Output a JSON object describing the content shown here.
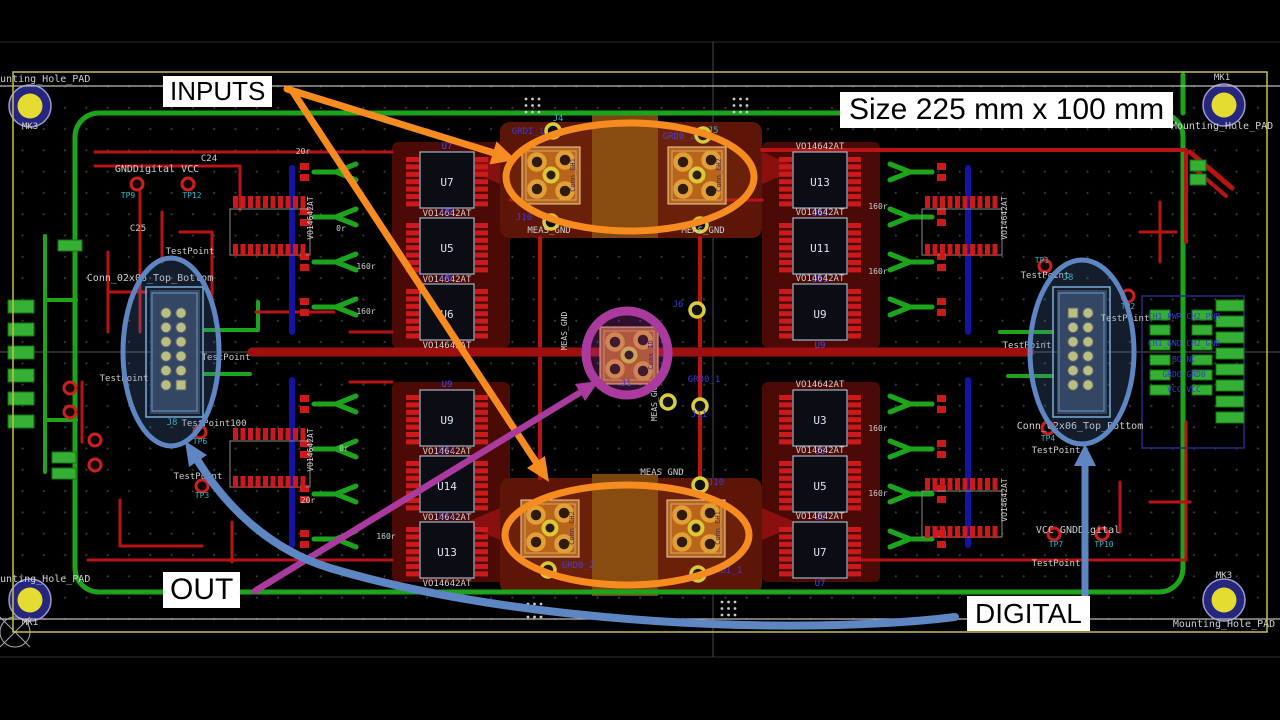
{
  "annotations": {
    "inputs": "INPUTS",
    "out": "OUT",
    "digital": "DIGITAL",
    "size": "Size 225 mm x 100 mm"
  },
  "colors": {
    "annotation_orange": "#f68b1f",
    "annotation_purple": "#aa3a9e",
    "annotation_blue": "#5d86c2",
    "trace_red": "#b81414",
    "trace_green": "#1ca51c",
    "copper_zone": "#4c0a06",
    "zone_orange": "#5c1507",
    "zone_brown": "#7c450f",
    "coax_body": "#b2611b",
    "board_outline": "#c8bd4a",
    "pad_yellow": "#d8ce3c",
    "pad_red": "#cc1a1a",
    "ring_orange": "#e0a238",
    "mount_yellow": "#e5dc31",
    "mount_ring": "#26267e",
    "silk_white": "#cfcfcf",
    "net_blue": "#3a3ad8",
    "tp_teal": "#27b9c9",
    "ic_ref": "#d9e4f2",
    "blue_ref": "#4848ee",
    "header_pad": "#d6cf6e",
    "header_stroke": "#85b8dc"
  },
  "board": {
    "ic_columns": [
      {
        "cx": 447,
        "ref_above": true,
        "value": "VO14642AT",
        "parts": [
          {
            "ref": "U7",
            "y": 152
          },
          {
            "ref": "U5",
            "y": 218
          },
          {
            "ref": "U6",
            "y": 284
          },
          {
            "ref": "U9",
            "y": 390
          },
          {
            "ref": "U14",
            "y": 456
          },
          {
            "ref": "U13",
            "y": 522
          }
        ]
      },
      {
        "cx": 820,
        "ref_above": false,
        "value": "VO14642AT",
        "parts": [
          {
            "ref": "U13",
            "y": 152
          },
          {
            "ref": "U11",
            "y": 218
          },
          {
            "ref": "U9",
            "y": 284
          },
          {
            "ref": "U3",
            "y": 390
          },
          {
            "ref": "U5",
            "y": 456
          },
          {
            "ref": "U7",
            "y": 522
          }
        ]
      }
    ],
    "coax_connectors": [
      {
        "x": 522,
        "y": 147,
        "label": "Conn_CH1"
      },
      {
        "x": 668,
        "y": 147,
        "label": "Conn_CH2"
      },
      {
        "x": 600,
        "y": 327,
        "label": "Coax_ID"
      },
      {
        "x": 521,
        "y": 500,
        "label": "Conn_CH2"
      },
      {
        "x": 667,
        "y": 500,
        "label": "Conn_CH1"
      }
    ],
    "silk_texts": [
      {
        "t": "Mounting_Hole_PAD",
        "x": -12,
        "y": 82,
        "c": "silk_white",
        "s": 10,
        "a": "start"
      },
      {
        "t": "MK3",
        "x": 30,
        "y": 129,
        "c": "silk_white",
        "s": 9
      },
      {
        "t": "MK1",
        "x": 1222,
        "y": 80,
        "c": "silk_white",
        "s": 9
      },
      {
        "t": "Mounting_Hole_PAD",
        "x": 1222,
        "y": 129,
        "c": "silk_white",
        "s": 10
      },
      {
        "t": "Mounting_Hole_PAD",
        "x": -12,
        "y": 582,
        "c": "silk_white",
        "s": 10,
        "a": "start"
      },
      {
        "t": "MK1",
        "x": 30,
        "y": 625,
        "c": "silk_white",
        "s": 9
      },
      {
        "t": "MK3",
        "x": 1224,
        "y": 578,
        "c": "silk_white",
        "s": 9
      },
      {
        "t": "Mounting_Hole_PAD",
        "x": 1224,
        "y": 627,
        "c": "silk_white",
        "s": 10
      },
      {
        "t": "GNDDigital VCC",
        "x": 157,
        "y": 172,
        "c": "silk_white",
        "s": 10
      },
      {
        "t": "TP9",
        "x": 128,
        "y": 198,
        "c": "tp_teal",
        "s": 8
      },
      {
        "t": "TP12",
        "x": 192,
        "y": 198,
        "c": "tp_teal",
        "s": 8
      },
      {
        "t": "C24",
        "x": 209,
        "y": 161,
        "c": "silk_white",
        "s": 9
      },
      {
        "t": "C25",
        "x": 138,
        "y": 231,
        "c": "silk_white",
        "s": 9
      },
      {
        "t": "Conn_02x06_Top_Bottom",
        "x": 150,
        "y": 281,
        "c": "silk_white",
        "s": 10
      },
      {
        "t": "TestPoint",
        "x": 190,
        "y": 254,
        "c": "silk_white",
        "s": 9
      },
      {
        "t": "TestPoint",
        "x": 226,
        "y": 360,
        "c": "silk_white",
        "s": 9
      },
      {
        "t": "TestPoint",
        "x": 124,
        "y": 381,
        "c": "silk_white",
        "s": 9
      },
      {
        "t": "J8",
        "x": 172,
        "y": 425,
        "c": "tp_teal",
        "s": 9
      },
      {
        "t": "TestPoint100",
        "x": 214,
        "y": 426,
        "c": "silk_white",
        "s": 9
      },
      {
        "t": "TP6",
        "x": 200,
        "y": 444,
        "c": "tp_teal",
        "s": 8
      },
      {
        "t": "TestPoint",
        "x": 198,
        "y": 479,
        "c": "silk_white",
        "s": 9
      },
      {
        "t": "TP3",
        "x": 202,
        "y": 498,
        "c": "tp_teal",
        "s": 8
      },
      {
        "t": "20r",
        "x": 303,
        "y": 154,
        "c": "silk_white",
        "s": 8
      },
      {
        "t": "0r",
        "x": 341,
        "y": 231,
        "c": "silk_white",
        "s": 8
      },
      {
        "t": "160r",
        "x": 366,
        "y": 269,
        "c": "silk_white",
        "s": 8
      },
      {
        "t": "160r",
        "x": 366,
        "y": 314,
        "c": "silk_white",
        "s": 8
      },
      {
        "t": "20r",
        "x": 308,
        "y": 503,
        "c": "silk_white",
        "s": 8
      },
      {
        "t": "0r",
        "x": 344,
        "y": 451,
        "c": "silk_white",
        "s": 8
      },
      {
        "t": "160r",
        "x": 386,
        "y": 539,
        "c": "silk_white",
        "s": 8
      },
      {
        "t": "160r",
        "x": 878,
        "y": 209,
        "c": "silk_white",
        "s": 8
      },
      {
        "t": "160r",
        "x": 878,
        "y": 274,
        "c": "silk_white",
        "s": 8
      },
      {
        "t": "160r",
        "x": 878,
        "y": 431,
        "c": "silk_white",
        "s": 8
      },
      {
        "t": "160r",
        "x": 878,
        "y": 496,
        "c": "silk_white",
        "s": 8
      },
      {
        "t": "GRDI_1",
        "x": 528,
        "y": 134,
        "c": "net_blue",
        "s": 9
      },
      {
        "t": "J4",
        "x": 558,
        "y": 121,
        "c": "tp_teal",
        "s": 9
      },
      {
        "t": "GRD0_2",
        "x": 679,
        "y": 139,
        "c": "net_blue",
        "s": 9
      },
      {
        "t": "J5",
        "x": 713,
        "y": 133,
        "c": "tp_teal",
        "s": 9
      },
      {
        "t": "J10",
        "x": 524,
        "y": 220,
        "c": "net_blue",
        "s": 9
      },
      {
        "t": "MEAS_GND",
        "x": 549,
        "y": 233,
        "c": "silk_white",
        "s": 9
      },
      {
        "t": "MEAS_GND",
        "x": 703,
        "y": 233,
        "c": "silk_white",
        "s": 9
      },
      {
        "t": "MEAS_GND",
        "x": 567,
        "y": 331,
        "c": "silk_white",
        "s": 8,
        "r": -90
      },
      {
        "t": "MEAS_GND",
        "x": 657,
        "y": 402,
        "c": "silk_white",
        "s": 8,
        "r": -90
      },
      {
        "t": "J6",
        "x": 678,
        "y": 307,
        "c": "net_blue",
        "s": 9
      },
      {
        "t": "GRD0_1",
        "x": 704,
        "y": 382,
        "c": "net_blue",
        "s": 9
      },
      {
        "t": "J1",
        "x": 626,
        "y": 386,
        "c": "net_blue",
        "s": 9
      },
      {
        "t": "J11",
        "x": 699,
        "y": 417,
        "c": "net_blue",
        "s": 9
      },
      {
        "t": "MEAS GND",
        "x": 662,
        "y": 475,
        "c": "silk_white",
        "s": 9
      },
      {
        "t": "J10",
        "x": 716,
        "y": 485,
        "c": "net_blue",
        "s": 9
      },
      {
        "t": "GRD0_2",
        "x": 578,
        "y": 568,
        "c": "net_blue",
        "s": 9
      },
      {
        "t": "GRDI_1",
        "x": 726,
        "y": 573,
        "c": "net_blue",
        "s": 9
      },
      {
        "t": "TestPoint",
        "x": 1045,
        "y": 278,
        "c": "silk_white",
        "s": 9
      },
      {
        "t": "TP1",
        "x": 1042,
        "y": 263,
        "c": "tp_teal",
        "s": 8
      },
      {
        "t": "J8",
        "x": 1068,
        "y": 280,
        "c": "tp_teal",
        "s": 9
      },
      {
        "t": "TP2",
        "x": 1128,
        "y": 309,
        "c": "tp_teal",
        "s": 8
      },
      {
        "t": "TestPoint",
        "x": 1125,
        "y": 321,
        "c": "silk_white",
        "s": 9
      },
      {
        "t": "TestPoint",
        "x": 1027,
        "y": 348,
        "c": "silk_white",
        "s": 9
      },
      {
        "t": "TP4",
        "x": 1048,
        "y": 441,
        "c": "tp_teal",
        "s": 8
      },
      {
        "t": "TestPoint",
        "x": 1056,
        "y": 453,
        "c": "silk_white",
        "s": 9
      },
      {
        "t": "Conn_02x06_Top_Bottom",
        "x": 1080,
        "y": 429,
        "c": "silk_white",
        "s": 10
      },
      {
        "t": "VCC GNDDigital",
        "x": 1078,
        "y": 533,
        "c": "silk_white",
        "s": 10
      },
      {
        "t": "TP7",
        "x": 1056,
        "y": 547,
        "c": "tp_teal",
        "s": 8
      },
      {
        "t": "TP10",
        "x": 1104,
        "y": 547,
        "c": "tp_teal",
        "s": 8
      },
      {
        "t": "TestPoint",
        "x": 1056,
        "y": 566,
        "c": "silk_white",
        "s": 9
      },
      {
        "t": "CH1_PWR  CH2_PWR",
        "x": 1184,
        "y": 319,
        "c": "net_blue",
        "s": 8
      },
      {
        "t": "CH1_GND  CH2_GND",
        "x": 1184,
        "y": 346,
        "c": "net_blue",
        "s": 8
      },
      {
        "t": "BO      NC",
        "x": 1184,
        "y": 362,
        "c": "net_blue",
        "s": 8
      },
      {
        "t": "GRD0    GRD0",
        "x": 1184,
        "y": 377,
        "c": "net_blue",
        "s": 8
      },
      {
        "t": "VCC     VCC",
        "x": 1184,
        "y": 392,
        "c": "net_blue",
        "s": 8
      },
      {
        "t": "VO14642AT",
        "x": 313,
        "y": 218,
        "c": "silk_white",
        "s": 8,
        "r": -90
      },
      {
        "t": "VO14642AT",
        "x": 313,
        "y": 450,
        "c": "silk_white",
        "s": 8,
        "r": -90
      },
      {
        "t": "VO14642AT",
        "x": 1007,
        "y": 218,
        "c": "silk_white",
        "s": 8,
        "r": -90
      },
      {
        "t": "VO14642AT",
        "x": 1007,
        "y": 500,
        "c": "silk_white",
        "s": 8,
        "r": -90
      }
    ]
  }
}
